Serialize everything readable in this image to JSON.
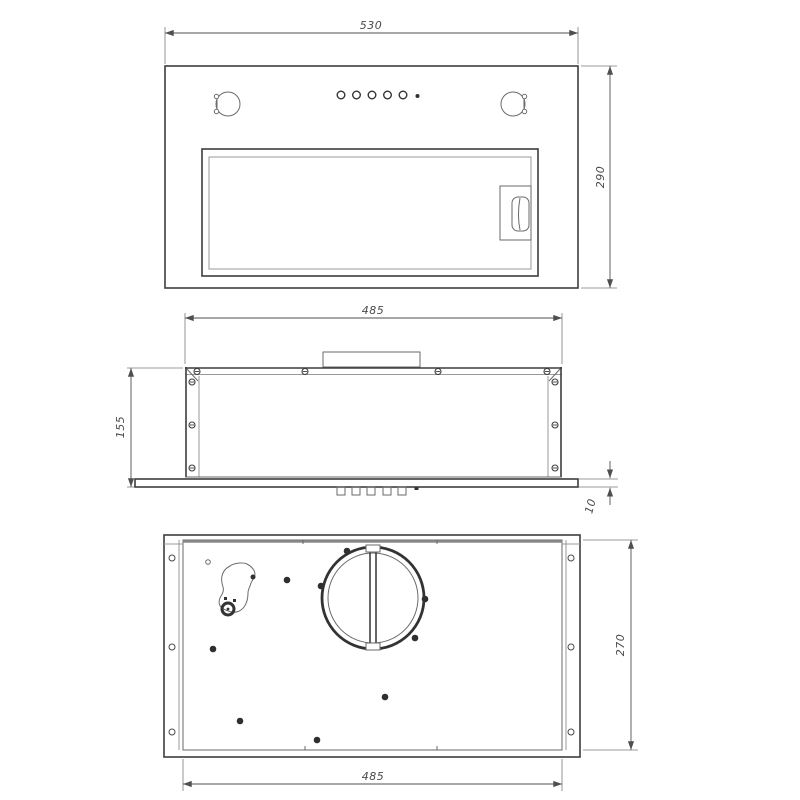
{
  "drawing_title": "built-in cooker hood dimensional drawing",
  "colors": {
    "background": "#ffffff",
    "object_line": "#3d3d3d",
    "thin_line": "#9a9a9a",
    "dimension_line": "#4f4f4f",
    "dimension_text": "#4a4a4a"
  },
  "views": {
    "front": {
      "name": "front-view",
      "dimensions": {
        "width": "530",
        "height": "290"
      }
    },
    "side": {
      "name": "side-view",
      "dimensions": {
        "width": "485",
        "height": "155",
        "panel_thickness": "10"
      }
    },
    "top": {
      "name": "top-view",
      "dimensions": {
        "depth": "270",
        "width": "485"
      }
    }
  }
}
